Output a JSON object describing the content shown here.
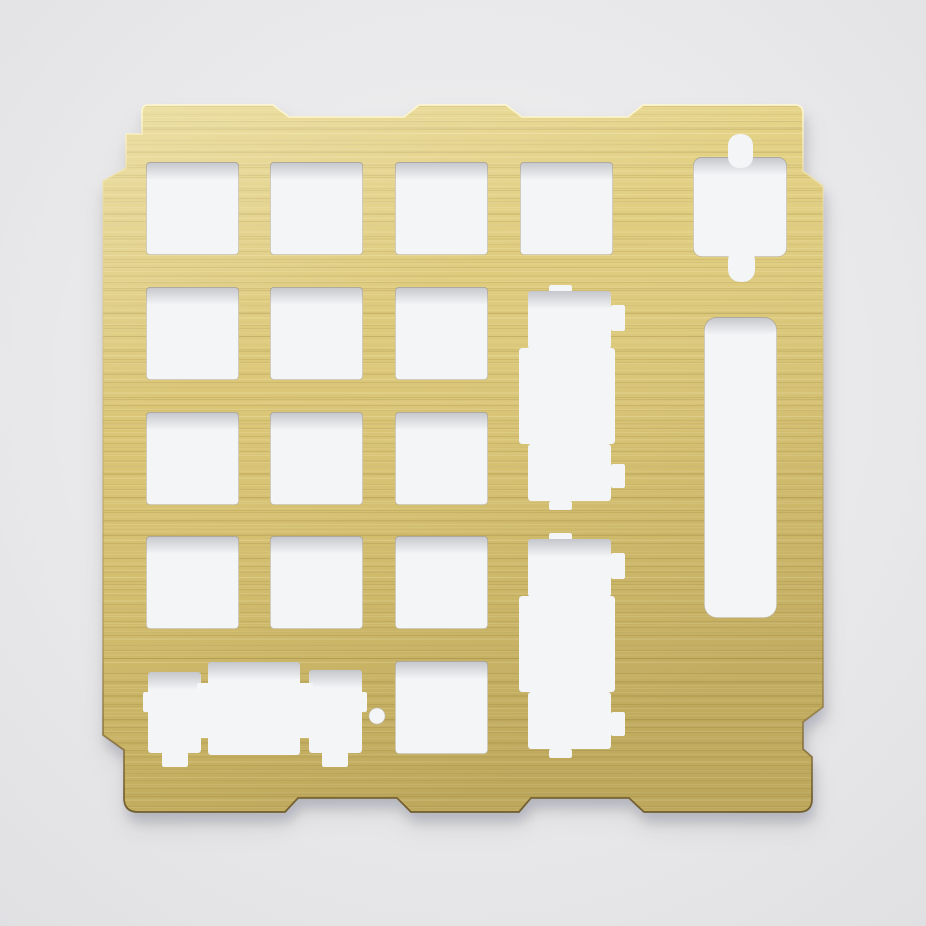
{
  "meta": {
    "subject": "brushed-brass-numpad-switch-plate-product-photo",
    "canvas": {
      "width": 926,
      "height": 926
    }
  },
  "palette": {
    "background_center": "#f0f0f1",
    "background_mid": "#e9e9eb",
    "background_edge": "#e0e0e3",
    "hole_fill": "#f4f5f6",
    "hole_top_shadow": "rgba(95,100,115,0.32)",
    "hole_rim": "rgba(120,98,45,0.38)",
    "brass_top": "#e4d286",
    "brass_mid": "#d9c474",
    "brass_bottom": "#cdb766",
    "streak_light": "rgba(255,250,220,0.14)",
    "streak_dark": "rgba(110,88,34,0.12)",
    "sheen_light": "rgba(255,253,232,0.30)",
    "sheen_dark": "rgba(80,60,15,0.13)",
    "edge_top": "rgba(255,248,210,0.9)",
    "edge_upper": "rgba(235,220,160,0.5)",
    "edge_lower": "rgba(160,135,70,0.55)",
    "edge_bottom": "rgba(105,85,38,0.9)",
    "shadow_near": "rgba(25,25,32,0.16)",
    "shadow_far": "rgba(25,25,32,0.08)"
  },
  "plate": {
    "label": "brass-numpad-switch-plate",
    "outline_path": "M148,105 H273 L289,117 H404 L419,105 H506 L522,117 H628 L643,105 H795 Q803,105 803,113 V171 L823,186 V707 L803,722 V749 L812,757 V799 Q812,812 799,812 H644 L629,798 H531 L519,812 H411 L397,798 H298 L285,812 H138 Q124,812 124,798 V750 L103,735 V181 L126,168 V134 H142 V112 Q142,105 148,105 Z",
    "holes": [
      {
        "name": "switch-cutout-r1c1",
        "shapes": [
          {
            "kind": "rect",
            "x": 146,
            "y": 162,
            "w": 93,
            "h": 93,
            "r": 4,
            "shade": true,
            "rim": true
          }
        ]
      },
      {
        "name": "switch-cutout-r1c2",
        "shapes": [
          {
            "kind": "rect",
            "x": 270,
            "y": 162,
            "w": 93,
            "h": 93,
            "r": 4,
            "shade": true,
            "rim": true
          }
        ]
      },
      {
        "name": "switch-cutout-r1c3",
        "shapes": [
          {
            "kind": "rect",
            "x": 395,
            "y": 162,
            "w": 93,
            "h": 93,
            "r": 4,
            "shade": true,
            "rim": true
          }
        ]
      },
      {
        "name": "switch-cutout-r1c4",
        "shapes": [
          {
            "kind": "rect",
            "x": 520,
            "y": 162,
            "w": 93,
            "h": 93,
            "r": 4,
            "shade": true,
            "rim": true
          }
        ]
      },
      {
        "name": "switch-cutout-r2c1",
        "shapes": [
          {
            "kind": "rect",
            "x": 146,
            "y": 287,
            "w": 93,
            "h": 93,
            "r": 4,
            "shade": true,
            "rim": true
          }
        ]
      },
      {
        "name": "switch-cutout-r2c2",
        "shapes": [
          {
            "kind": "rect",
            "x": 270,
            "y": 287,
            "w": 93,
            "h": 93,
            "r": 4,
            "shade": true,
            "rim": true
          }
        ]
      },
      {
        "name": "switch-cutout-r2c3",
        "shapes": [
          {
            "kind": "rect",
            "x": 395,
            "y": 287,
            "w": 93,
            "h": 93,
            "r": 4,
            "shade": true,
            "rim": true
          }
        ]
      },
      {
        "name": "switch-cutout-r3c1",
        "shapes": [
          {
            "kind": "rect",
            "x": 146,
            "y": 412,
            "w": 93,
            "h": 93,
            "r": 4,
            "shade": true,
            "rim": true
          }
        ]
      },
      {
        "name": "switch-cutout-r3c2",
        "shapes": [
          {
            "kind": "rect",
            "x": 270,
            "y": 412,
            "w": 93,
            "h": 93,
            "r": 4,
            "shade": true,
            "rim": true
          }
        ]
      },
      {
        "name": "switch-cutout-r3c3",
        "shapes": [
          {
            "kind": "rect",
            "x": 395,
            "y": 412,
            "w": 93,
            "h": 93,
            "r": 4,
            "shade": true,
            "rim": true
          }
        ]
      },
      {
        "name": "switch-cutout-r4c1",
        "shapes": [
          {
            "kind": "rect",
            "x": 146,
            "y": 536,
            "w": 93,
            "h": 93,
            "r": 4,
            "shade": true,
            "rim": true
          }
        ]
      },
      {
        "name": "switch-cutout-r4c2",
        "shapes": [
          {
            "kind": "rect",
            "x": 270,
            "y": 536,
            "w": 93,
            "h": 93,
            "r": 4,
            "shade": true,
            "rim": true
          }
        ]
      },
      {
        "name": "switch-cutout-r4c3",
        "shapes": [
          {
            "kind": "rect",
            "x": 395,
            "y": 536,
            "w": 93,
            "h": 93,
            "r": 4,
            "shade": true,
            "rim": true
          }
        ]
      },
      {
        "name": "switch-cutout-r5c3",
        "shapes": [
          {
            "kind": "rect",
            "x": 395,
            "y": 661,
            "w": 93,
            "h": 93,
            "r": 4,
            "shade": true,
            "rim": true
          }
        ]
      },
      {
        "name": "stabilized-2u-cutout-zero-key",
        "shapes": [
          {
            "kind": "rect",
            "x": 208,
            "y": 662,
            "w": 92,
            "h": 93,
            "r": 3,
            "shade": true
          },
          {
            "kind": "rect",
            "x": 148,
            "y": 672,
            "w": 53,
            "h": 81,
            "r": 3,
            "shade": true
          },
          {
            "kind": "rect",
            "x": 197,
            "y": 683,
            "w": 16,
            "h": 55,
            "r": 2
          },
          {
            "kind": "rect",
            "x": 309,
            "y": 670,
            "w": 53,
            "h": 83,
            "r": 3,
            "shade": true
          },
          {
            "kind": "rect",
            "x": 295,
            "y": 683,
            "w": 18,
            "h": 55,
            "r": 2
          },
          {
            "kind": "rect",
            "x": 143,
            "y": 692,
            "w": 9,
            "h": 20,
            "r": 2
          },
          {
            "kind": "rect",
            "x": 358,
            "y": 692,
            "w": 9,
            "h": 20,
            "r": 2
          },
          {
            "kind": "rect",
            "x": 162,
            "y": 748,
            "w": 26,
            "h": 19,
            "r": 2
          },
          {
            "kind": "rect",
            "x": 322,
            "y": 748,
            "w": 26,
            "h": 19,
            "r": 2
          }
        ]
      },
      {
        "name": "stabilized-2u-vertical-cutout-plus-key",
        "shapes": [
          {
            "kind": "rect",
            "x": 549,
            "y": 285,
            "w": 23,
            "h": 8,
            "r": 2
          },
          {
            "kind": "rect",
            "x": 528,
            "y": 291,
            "w": 83,
            "h": 58,
            "r": 3,
            "shade": true
          },
          {
            "kind": "rect",
            "x": 611,
            "y": 305,
            "w": 14,
            "h": 26,
            "r": 2
          },
          {
            "kind": "rect",
            "x": 519,
            "y": 348,
            "w": 96,
            "h": 96,
            "r": 3
          },
          {
            "kind": "rect",
            "x": 528,
            "y": 444,
            "w": 83,
            "h": 57,
            "r": 3
          },
          {
            "kind": "rect",
            "x": 611,
            "y": 464,
            "w": 14,
            "h": 24,
            "r": 2
          },
          {
            "kind": "rect",
            "x": 549,
            "y": 501,
            "w": 23,
            "h": 9,
            "r": 2
          }
        ]
      },
      {
        "name": "stabilized-2u-vertical-cutout-enter-key",
        "shapes": [
          {
            "kind": "rect",
            "x": 549,
            "y": 533,
            "w": 23,
            "h": 8,
            "r": 2
          },
          {
            "kind": "rect",
            "x": 528,
            "y": 539,
            "w": 83,
            "h": 58,
            "r": 3,
            "shade": true
          },
          {
            "kind": "rect",
            "x": 611,
            "y": 553,
            "w": 14,
            "h": 26,
            "r": 2
          },
          {
            "kind": "rect",
            "x": 519,
            "y": 596,
            "w": 96,
            "h": 96,
            "r": 3
          },
          {
            "kind": "rect",
            "x": 528,
            "y": 692,
            "w": 83,
            "h": 57,
            "r": 3
          },
          {
            "kind": "rect",
            "x": 611,
            "y": 712,
            "w": 14,
            "h": 24,
            "r": 2
          },
          {
            "kind": "rect",
            "x": 549,
            "y": 749,
            "w": 23,
            "h": 9,
            "r": 2
          }
        ]
      },
      {
        "name": "connector-cutout",
        "shapes": [
          {
            "kind": "rect",
            "x": 693,
            "y": 157,
            "w": 94,
            "h": 100,
            "r": 9,
            "shade": true,
            "rim": true
          },
          {
            "kind": "rect",
            "x": 728,
            "y": 134,
            "w": 25,
            "h": 34,
            "r": 11
          },
          {
            "kind": "rect",
            "x": 728,
            "y": 248,
            "w": 27,
            "h": 34,
            "r": 12
          }
        ]
      },
      {
        "name": "vertical-slot-cutout",
        "shapes": [
          {
            "kind": "rect",
            "x": 704,
            "y": 317,
            "w": 73,
            "h": 301,
            "r": 13,
            "shade": true,
            "rim": true
          }
        ]
      },
      {
        "name": "alignment-hole",
        "shapes": [
          {
            "kind": "circle",
            "cx": 377,
            "cy": 716,
            "r": 8.5,
            "rim": true
          }
        ]
      }
    ]
  }
}
